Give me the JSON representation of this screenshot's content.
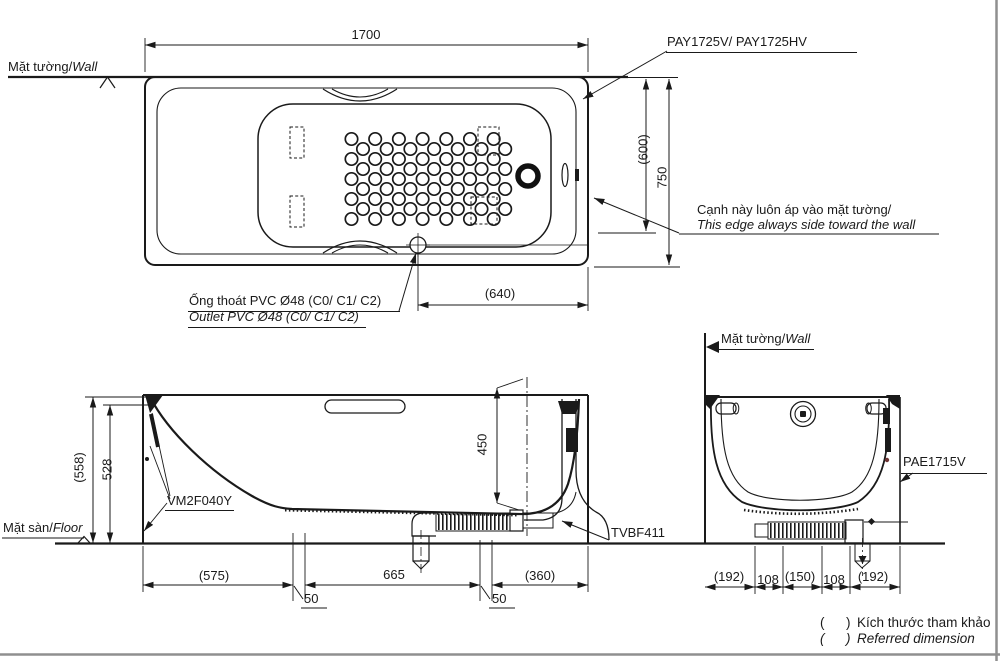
{
  "colors": {
    "ink": "#1a1a1a",
    "frame": "#8f8f8f",
    "background": "#ffffff"
  },
  "top_view": {
    "wall_label_vi": "Mặt tường/",
    "wall_label_en": "Wall",
    "model_label": "PAY1725V/ PAY1725HV",
    "dim_length": "1700",
    "dim_width": "750",
    "dim_width_ref": "(600)",
    "dim_drain_offset": "(640)",
    "edge_note_vi": "Cạnh này luôn áp vào mặt tường/",
    "edge_note_en": "This edge always side toward the wall",
    "outlet_note_vi": "Ống thoát PVC Ø48 (C0/ C1/ C2)",
    "outlet_note_en": "Outlet PVC Ø48 (C0/ C1/ C2)"
  },
  "side_view": {
    "floor_label_vi": "Mặt sàn/",
    "floor_label_en": "Floor",
    "dim_height_ref": "(558)",
    "dim_height_rim": "528",
    "dim_depth": "450",
    "part_bracket": "VM2F040Y",
    "part_waste": "TVBF411",
    "dim_head": "(575)",
    "dim_gap_left": "50",
    "dim_bottom": "665",
    "dim_gap_right": "50",
    "dim_foot": "(360)"
  },
  "end_view": {
    "wall_label_vi": "Mặt tường/",
    "wall_label_en": "Wall",
    "part_panel": "PAE1715V",
    "dim_1": "(192)",
    "dim_2": "108",
    "dim_3": "(150)",
    "dim_4": "108",
    "dim_5": "(192)"
  },
  "legend": {
    "paren_open": "(",
    "paren_close": ")",
    "note_vi": "Kích thước tham khảo",
    "note_en": "Referred dimension"
  }
}
